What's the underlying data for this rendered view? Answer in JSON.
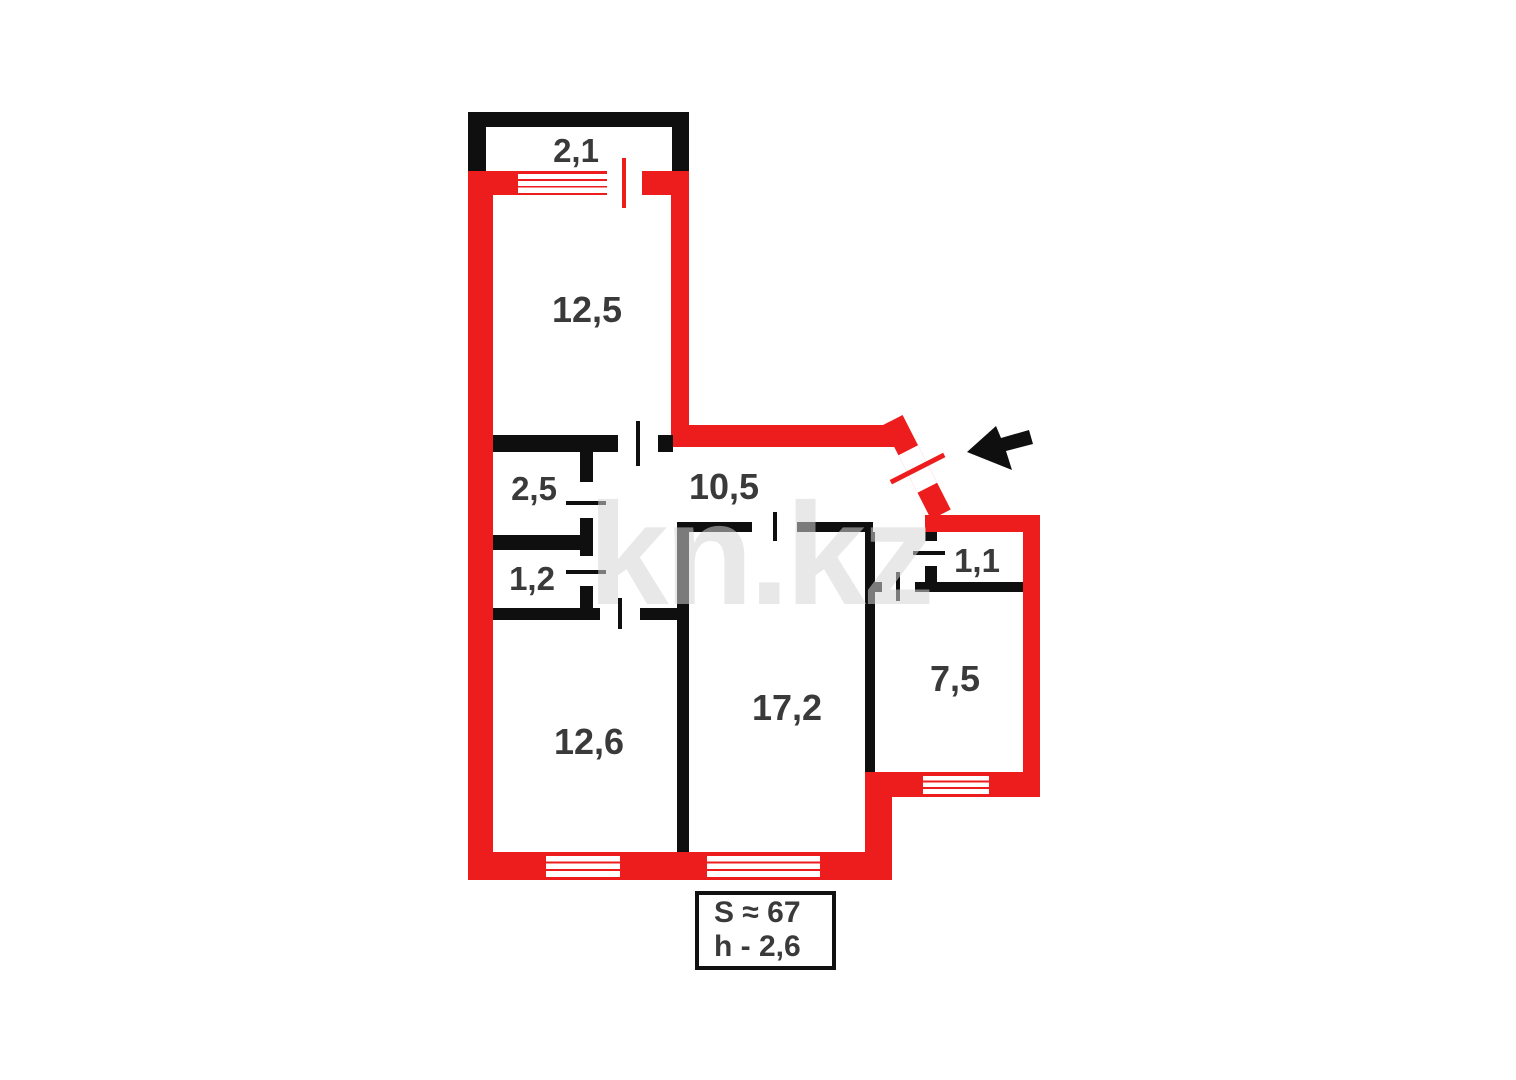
{
  "plan": {
    "title": "apartment-floor-plan",
    "rooms": [
      {
        "id": "balcony",
        "label": "2,1"
      },
      {
        "id": "room-12-5",
        "label": "12,5"
      },
      {
        "id": "room-2-5",
        "label": "2,5"
      },
      {
        "id": "hallway",
        "label": "10,5"
      },
      {
        "id": "room-1-2",
        "label": "1,2"
      },
      {
        "id": "room-1-1",
        "label": "1,1"
      },
      {
        "id": "room-12-6",
        "label": "12,6"
      },
      {
        "id": "room-17-2",
        "label": "17,2"
      },
      {
        "id": "room-7-5",
        "label": "7,5"
      }
    ],
    "info_box": {
      "area": "S ≈ 67",
      "height": "h - 2,6"
    },
    "watermark": "kn.kz",
    "entrance": {
      "indicator": "arrow pointing to entrance door"
    },
    "colors": {
      "outer_wall_red": "#ee1d1d",
      "inner_wall_black": "#0f0f0f",
      "label_text": "#3a3a3a",
      "watermark_gray": "#d5d5d5",
      "background": "#ffffff"
    }
  }
}
